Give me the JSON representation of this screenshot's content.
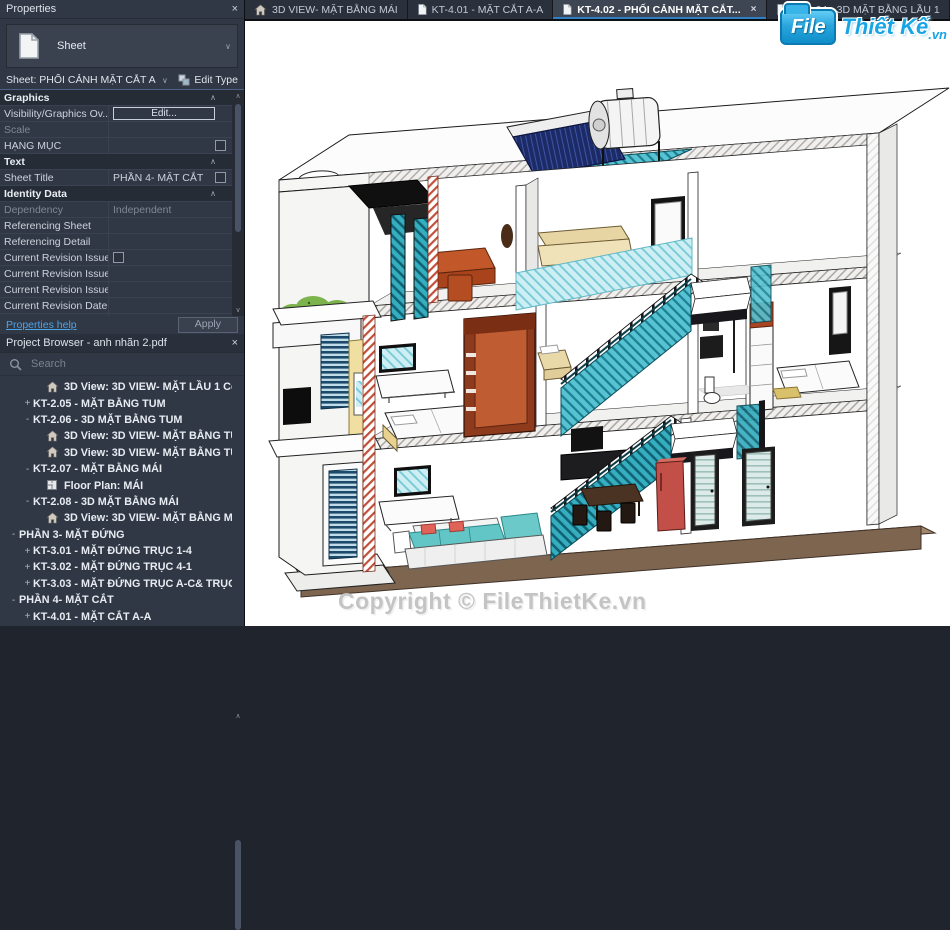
{
  "icons": {
    "close": "×",
    "chevron_down": "∨",
    "chevron_up": "∧",
    "section_collapse": "∧"
  },
  "tabs": [
    {
      "icon": "home",
      "label": "3D VIEW- MẶT BẰNG MÁI",
      "active": false
    },
    {
      "icon": "sheet",
      "label": "KT-4.01 - MẶT CẮT A-A",
      "active": false
    },
    {
      "icon": "sheet",
      "label": "KT-4.02 - PHỐI CẢNH MẶT CẮT...",
      "active": true,
      "close_icon": "×"
    },
    {
      "icon": "sheet",
      "label": "KT-2.04 - 3D MẶT BẰNG LẦU 1",
      "active": false
    },
    {
      "icon": "sheet",
      "label": "KT-2.0",
      "active": false
    }
  ],
  "properties_panel": {
    "title": "Properties",
    "close_icon": "×",
    "type_selector": {
      "label": "Sheet",
      "arrow": "∨"
    },
    "sheet_selector": {
      "value": "Sheet: PHỐI CẢNH MẶT CẮT A-A",
      "arrow": "∨"
    },
    "edit_type_label": "Edit Type",
    "rows": [
      {
        "kind": "section",
        "label": "Graphics"
      },
      {
        "kind": "item",
        "label": "Visibility/Graphics Ov...",
        "control": "button",
        "value": "Edit..."
      },
      {
        "kind": "item",
        "label": "Scale",
        "value": "",
        "disabled": true
      },
      {
        "kind": "item",
        "label": "HẠNG MỤC",
        "control": "checkbox-right"
      },
      {
        "kind": "section",
        "label": "Text"
      },
      {
        "kind": "item",
        "label": "Sheet Title",
        "value": "PHẦN 4- MẶT CẮT",
        "control": "checkbox-right"
      },
      {
        "kind": "section",
        "label": "Identity Data"
      },
      {
        "kind": "item",
        "label": "Dependency",
        "value": "Independent",
        "disabled": true
      },
      {
        "kind": "item",
        "label": "Referencing Sheet",
        "value": ""
      },
      {
        "kind": "item",
        "label": "Referencing Detail",
        "value": ""
      },
      {
        "kind": "item",
        "label": "Current Revision Issued",
        "control": "checkbox-left"
      },
      {
        "kind": "item",
        "label": "Current Revision Issue...",
        "value": ""
      },
      {
        "kind": "item",
        "label": "Current Revision Issue...",
        "value": ""
      },
      {
        "kind": "item",
        "label": "Current Revision Date",
        "value": ""
      },
      {
        "kind": "item",
        "label": "Current Revision Desc...",
        "value": ""
      }
    ],
    "help_link": "Properties help",
    "apply_button": "Apply"
  },
  "project_browser": {
    "title": "Project Browser - anh nhãn 2.pdf",
    "close_icon": "×",
    "search_placeholder": "Search",
    "tree": [
      {
        "indent": 2,
        "icon": "home",
        "label": "3D View: 3D VIEW- MẶT LẦU 1 Copy"
      },
      {
        "indent": 1,
        "expander": "+",
        "label": "KT-2.05 - MẶT BẰNG TUM"
      },
      {
        "indent": 1,
        "expander": "-",
        "label": "KT-2.06 - 3D MẶT BẰNG TUM"
      },
      {
        "indent": 2,
        "icon": "home",
        "label": "3D View: 3D VIEW- MẶT BẰNG TUM"
      },
      {
        "indent": 2,
        "icon": "home",
        "label": "3D View: 3D VIEW- MẶT BẰNG TUM"
      },
      {
        "indent": 1,
        "expander": "-",
        "label": "KT-2.07 - MẶT BẰNG MÁI"
      },
      {
        "indent": 2,
        "icon": "floorplan",
        "label": "Floor Plan: MÁI"
      },
      {
        "indent": 1,
        "expander": "-",
        "label": "KT-2.08 - 3D MẶT BẰNG MÁI"
      },
      {
        "indent": 2,
        "icon": "home",
        "label": "3D View: 3D VIEW- MẶT BẰNG MÁI"
      },
      {
        "indent": 0,
        "expander": "-",
        "label": "PHẦN 3- MẶT ĐỨNG"
      },
      {
        "indent": 1,
        "expander": "+",
        "label": "KT-3.01 - MẶT ĐỨNG TRỤC 1-4"
      },
      {
        "indent": 1,
        "expander": "+",
        "label": "KT-3.02 - MẶT ĐỨNG TRỤC 4-1"
      },
      {
        "indent": 1,
        "expander": "+",
        "label": "KT-3.03 - MẶT ĐỨNG TRỤC A-C& TRỤC C-A"
      },
      {
        "indent": 0,
        "expander": "-",
        "label": "PHẦN 4- MẶT CẮT"
      },
      {
        "indent": 1,
        "expander": "+",
        "label": "KT-4.01 - MẶT CẮT A-A"
      }
    ]
  },
  "viewport": {
    "watermark": "Copyright © FileThietKe.vn",
    "logo": {
      "file": "File",
      "thietke": "Thiết Kế",
      "vn": ".vn"
    }
  },
  "colors": {
    "accent_blue": "#2f7fc4",
    "logo_blue": "#18a4e5",
    "stair_glass_teal": "#45b6c6",
    "cut_hatch_red": "#b5442c",
    "watermark_gray": "#c4c4c4",
    "panel_bg": "#313845",
    "section_header_bg": "#262c36",
    "base_brown": "#7d6550",
    "canvas_bg": "#ffffff"
  }
}
